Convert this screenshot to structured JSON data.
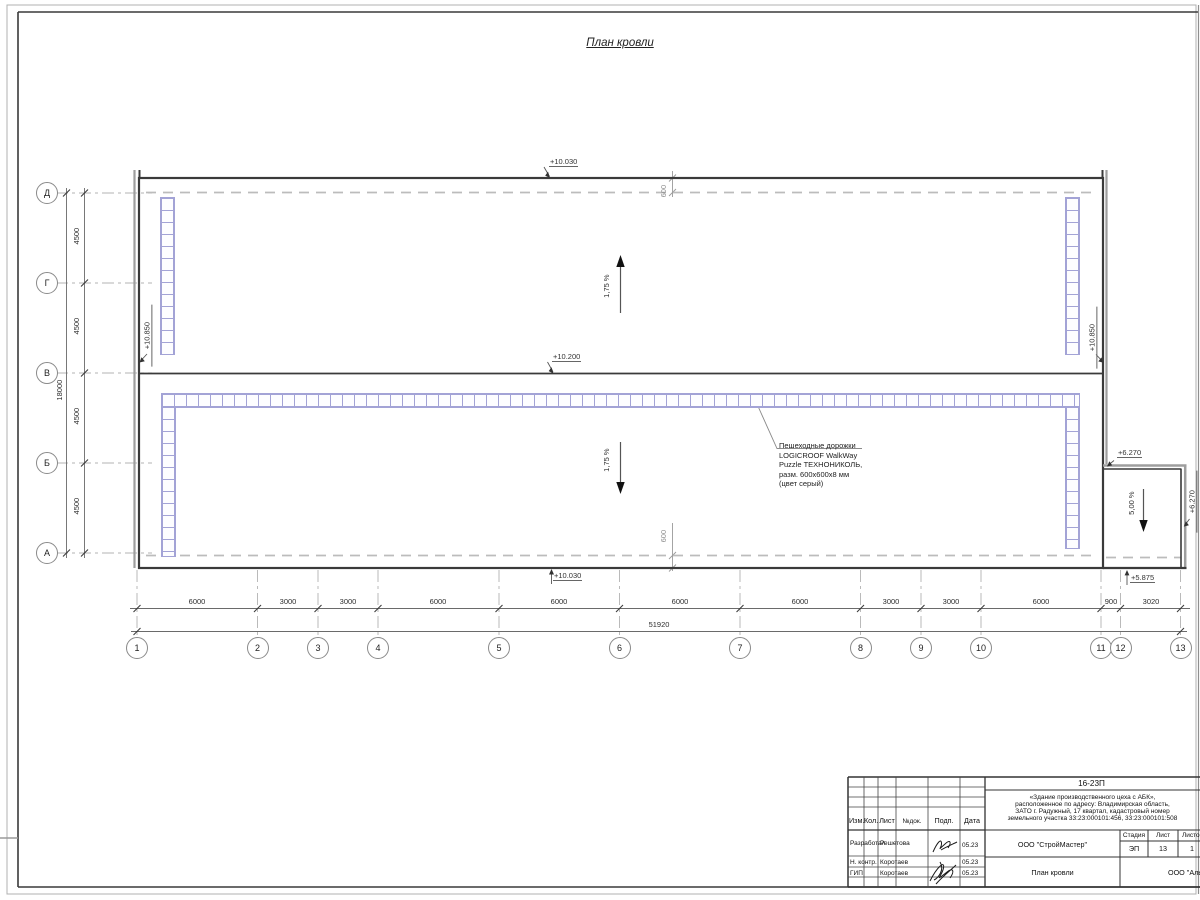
{
  "sheet": {
    "title": "План кровли"
  },
  "grid": {
    "rows": [
      "Д",
      "Г",
      "В",
      "Б",
      "А"
    ],
    "cols": [
      "1",
      "2",
      "3",
      "4",
      "5",
      "6",
      "7",
      "8",
      "9",
      "10",
      "11",
      "12",
      "13"
    ]
  },
  "dims": {
    "h_segments": [
      "6000",
      "3000",
      "3000",
      "6000",
      "6000",
      "6000",
      "6000",
      "3000",
      "3000",
      "6000",
      "900",
      "3020"
    ],
    "h_total": "51920",
    "v_segments": [
      "4500",
      "4500",
      "4500",
      "4500"
    ],
    "v_total": "18000",
    "offset_top": "600",
    "offset_bottom": "600"
  },
  "elevations": {
    "top": "+10.030",
    "ridge": "+10.200",
    "bottom": "+10.030",
    "left": "+10.850",
    "right": "+10.850",
    "annex_top": "+6.270",
    "annex_right": "+6.270",
    "annex_base": "+5.875"
  },
  "slopes": {
    "upper": "1,75 %",
    "lower": "1,75 %",
    "annex": "5,00 %"
  },
  "annotation": {
    "lines": [
      "Пешеходные дорожки",
      "LOGICROOF WalkWay",
      "Puzzle ТЕХНОНИКОЛЬ,",
      "разм. 600х600х8 мм",
      "(цвет серый)"
    ]
  },
  "titleblock": {
    "doc_number": "16-23П",
    "description": [
      "«Здание производственного цеха с АБК»,",
      "расположенное по адресу: Владимирская область,",
      "ЗАТО г. Радужный, 17 квартал, кадастровый номер",
      "земельного участка 33:23:000101:456, 33:23:000101:508"
    ],
    "columns": [
      "Изм.",
      "Кол.",
      "Лист",
      "№док.",
      "Подп.",
      "Дата"
    ],
    "rows": [
      {
        "role": "Разработал",
        "name": "Решетова",
        "date": "05.23"
      },
      {
        "role": "Н. контр.",
        "name": "Коротаев",
        "date": "05.23"
      },
      {
        "role": "ГИП",
        "name": "Коротаев",
        "date": "05.23"
      }
    ],
    "org": "ООО \"СтройМастер\"",
    "stage_label": "Стадия",
    "sheet_label": "Лист",
    "sheets_label": "Листов",
    "stage": "ЭП",
    "sheet_num": "13",
    "sheets_num": "1",
    "drawing_name": "План кровли",
    "contractor": "ООО \"Альянс\""
  }
}
